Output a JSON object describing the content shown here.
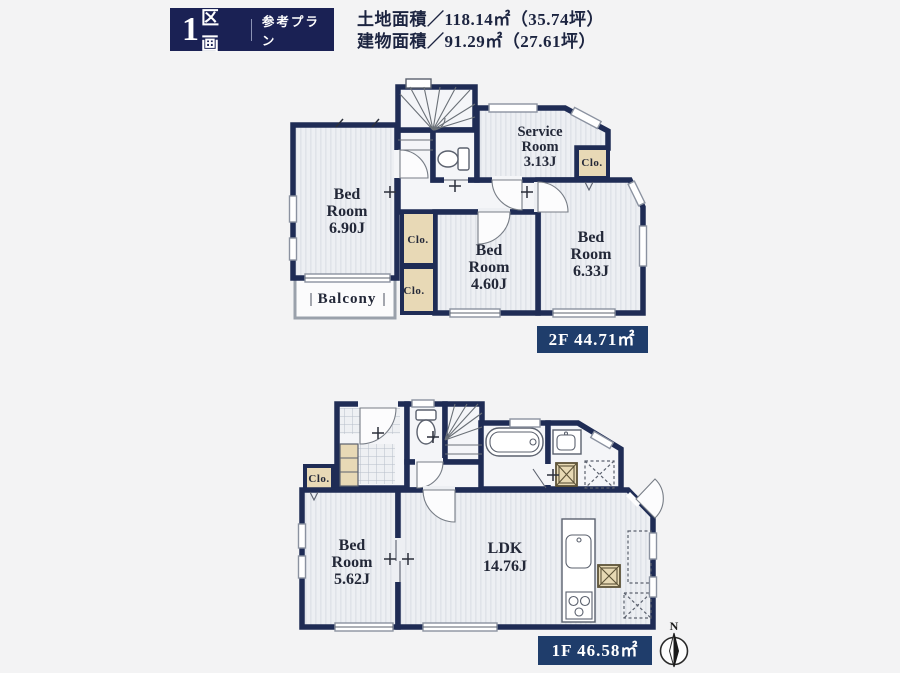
{
  "header": {
    "plot_number": "1",
    "plot_label": "区画",
    "plan_label": "参考プラン",
    "land_area": "土地面積／118.14㎡（35.74坪）",
    "building_area": "建物面積／91.29㎡（27.61坪）"
  },
  "floor2": {
    "label": "2F 44.71㎡",
    "bedroom_a": {
      "l1": "Bed",
      "l2": "Room",
      "l3": "6.90J"
    },
    "service_room": {
      "l1": "Service",
      "l2": "Room",
      "l3": "3.13J"
    },
    "bedroom_b": {
      "l1": "Bed",
      "l2": "Room",
      "l3": "6.33J"
    },
    "bedroom_c": {
      "l1": "Bed",
      "l2": "Room",
      "l3": "4.60J"
    },
    "closet_right": "Clo.",
    "closet_upper": "Clo.",
    "closet_lower": "Clo.",
    "balcony": "Balcony"
  },
  "floor1": {
    "label": "1F 46.58㎡",
    "bedroom": {
      "l1": "Bed",
      "l2": "Room",
      "l3": "5.62J"
    },
    "ldk": {
      "l1": "LDK",
      "l2": "14.76J"
    },
    "closet": "Clo."
  },
  "compass": {
    "north": "N"
  },
  "colors": {
    "wall_navy": "#1f2c55",
    "header_navy": "#1a2154",
    "label_navy": "#1f3d6b",
    "closet_beige": "#e8d9b6",
    "room_fill": "#eef0f4",
    "background": "#f3f3f4"
  }
}
